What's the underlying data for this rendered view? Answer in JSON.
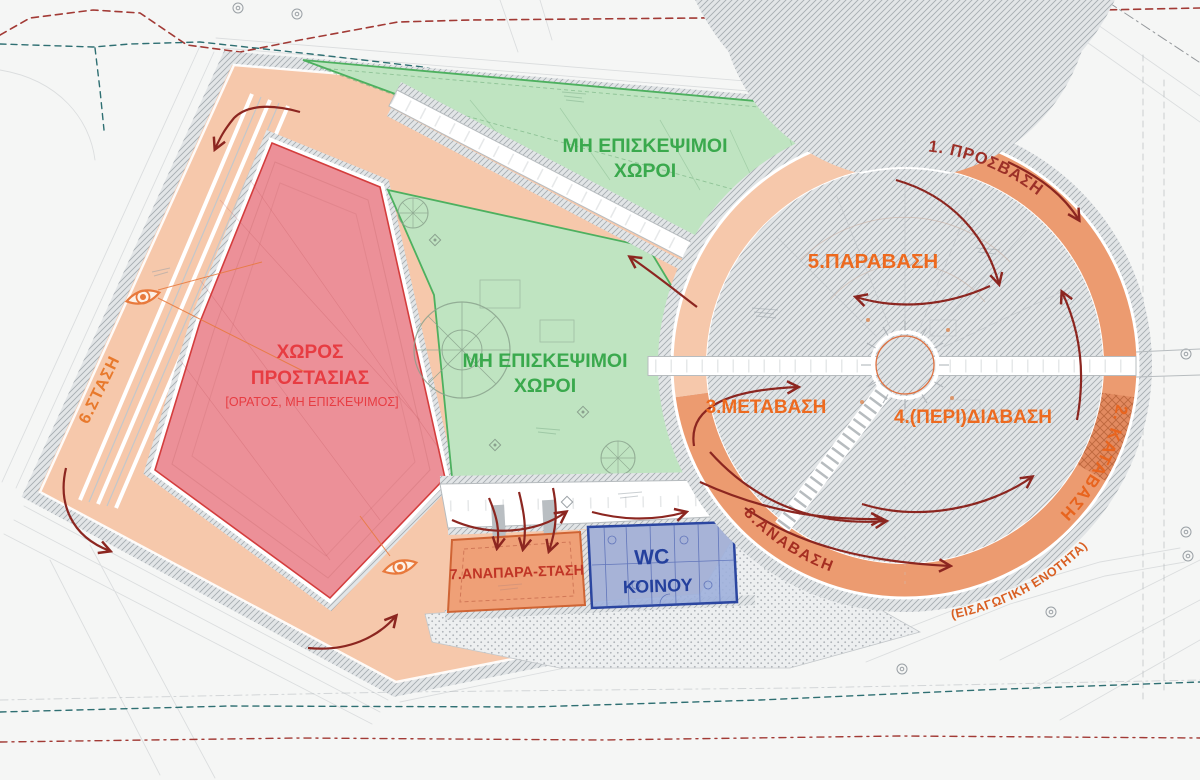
{
  "diagram": {
    "kind": "architectural-site-circulation-plan",
    "zones": {
      "zone1": "1. ΠΡΟΣΒΑΣΗ",
      "zone2": "2. ΚΑΤΑΒΑΣΗ",
      "zone2_note": "(ΕΙΣΑΓΩΓΙΚΗ ΕΝΟΤΗΤΑ)",
      "zone3": "3.ΜΕΤΑΒΑΣΗ",
      "zone4": "4.(ΠΕΡΙ)ΔΙΑΒΑΣΗ",
      "zone5": "5.ΠΑΡΑΒΑΣΗ",
      "zone6": "6.ΣΤΑΣΗ",
      "zone7": "7.ΑΝΑΠΑΡΑ-ΣΤΑΣΗ",
      "zone8": "8.ΑΝΑΒΑΣΗ"
    },
    "areas": {
      "protection_line1": "ΧΩΡΟΣ",
      "protection_line2": "ΠΡΟΣΤΑΣΙΑΣ",
      "protection_note": "[ΟΡΑΤΟΣ, ΜΗ ΕΠΙΣΚΕΨΙΜΟΣ]",
      "non_visitable_line1": "ΜΗ ΕΠΙΣΚΕΨΙΜΟΙ",
      "non_visitable_line2": "ΧΩΡΟΙ",
      "wc_line1": "WC",
      "wc_line2": "ΚΟΙΝΟΥ"
    },
    "colors": {
      "path_light_peach": "#f6c8ab",
      "path_dark_orange": "#ec9b70",
      "protected_red_fill": "#ec9098",
      "green_fill": "#bfe4c1",
      "wc_blue_fill": "#9fb0dc",
      "arrow_dark_red": "#8c2620",
      "label_orange": "#ed6a1f",
      "label_dark_red": "#9c3028",
      "label_red": "#e73c42",
      "label_green": "#3aa94d",
      "label_blue": "#24409d",
      "eye_icon_orange": "#e8793c"
    }
  }
}
